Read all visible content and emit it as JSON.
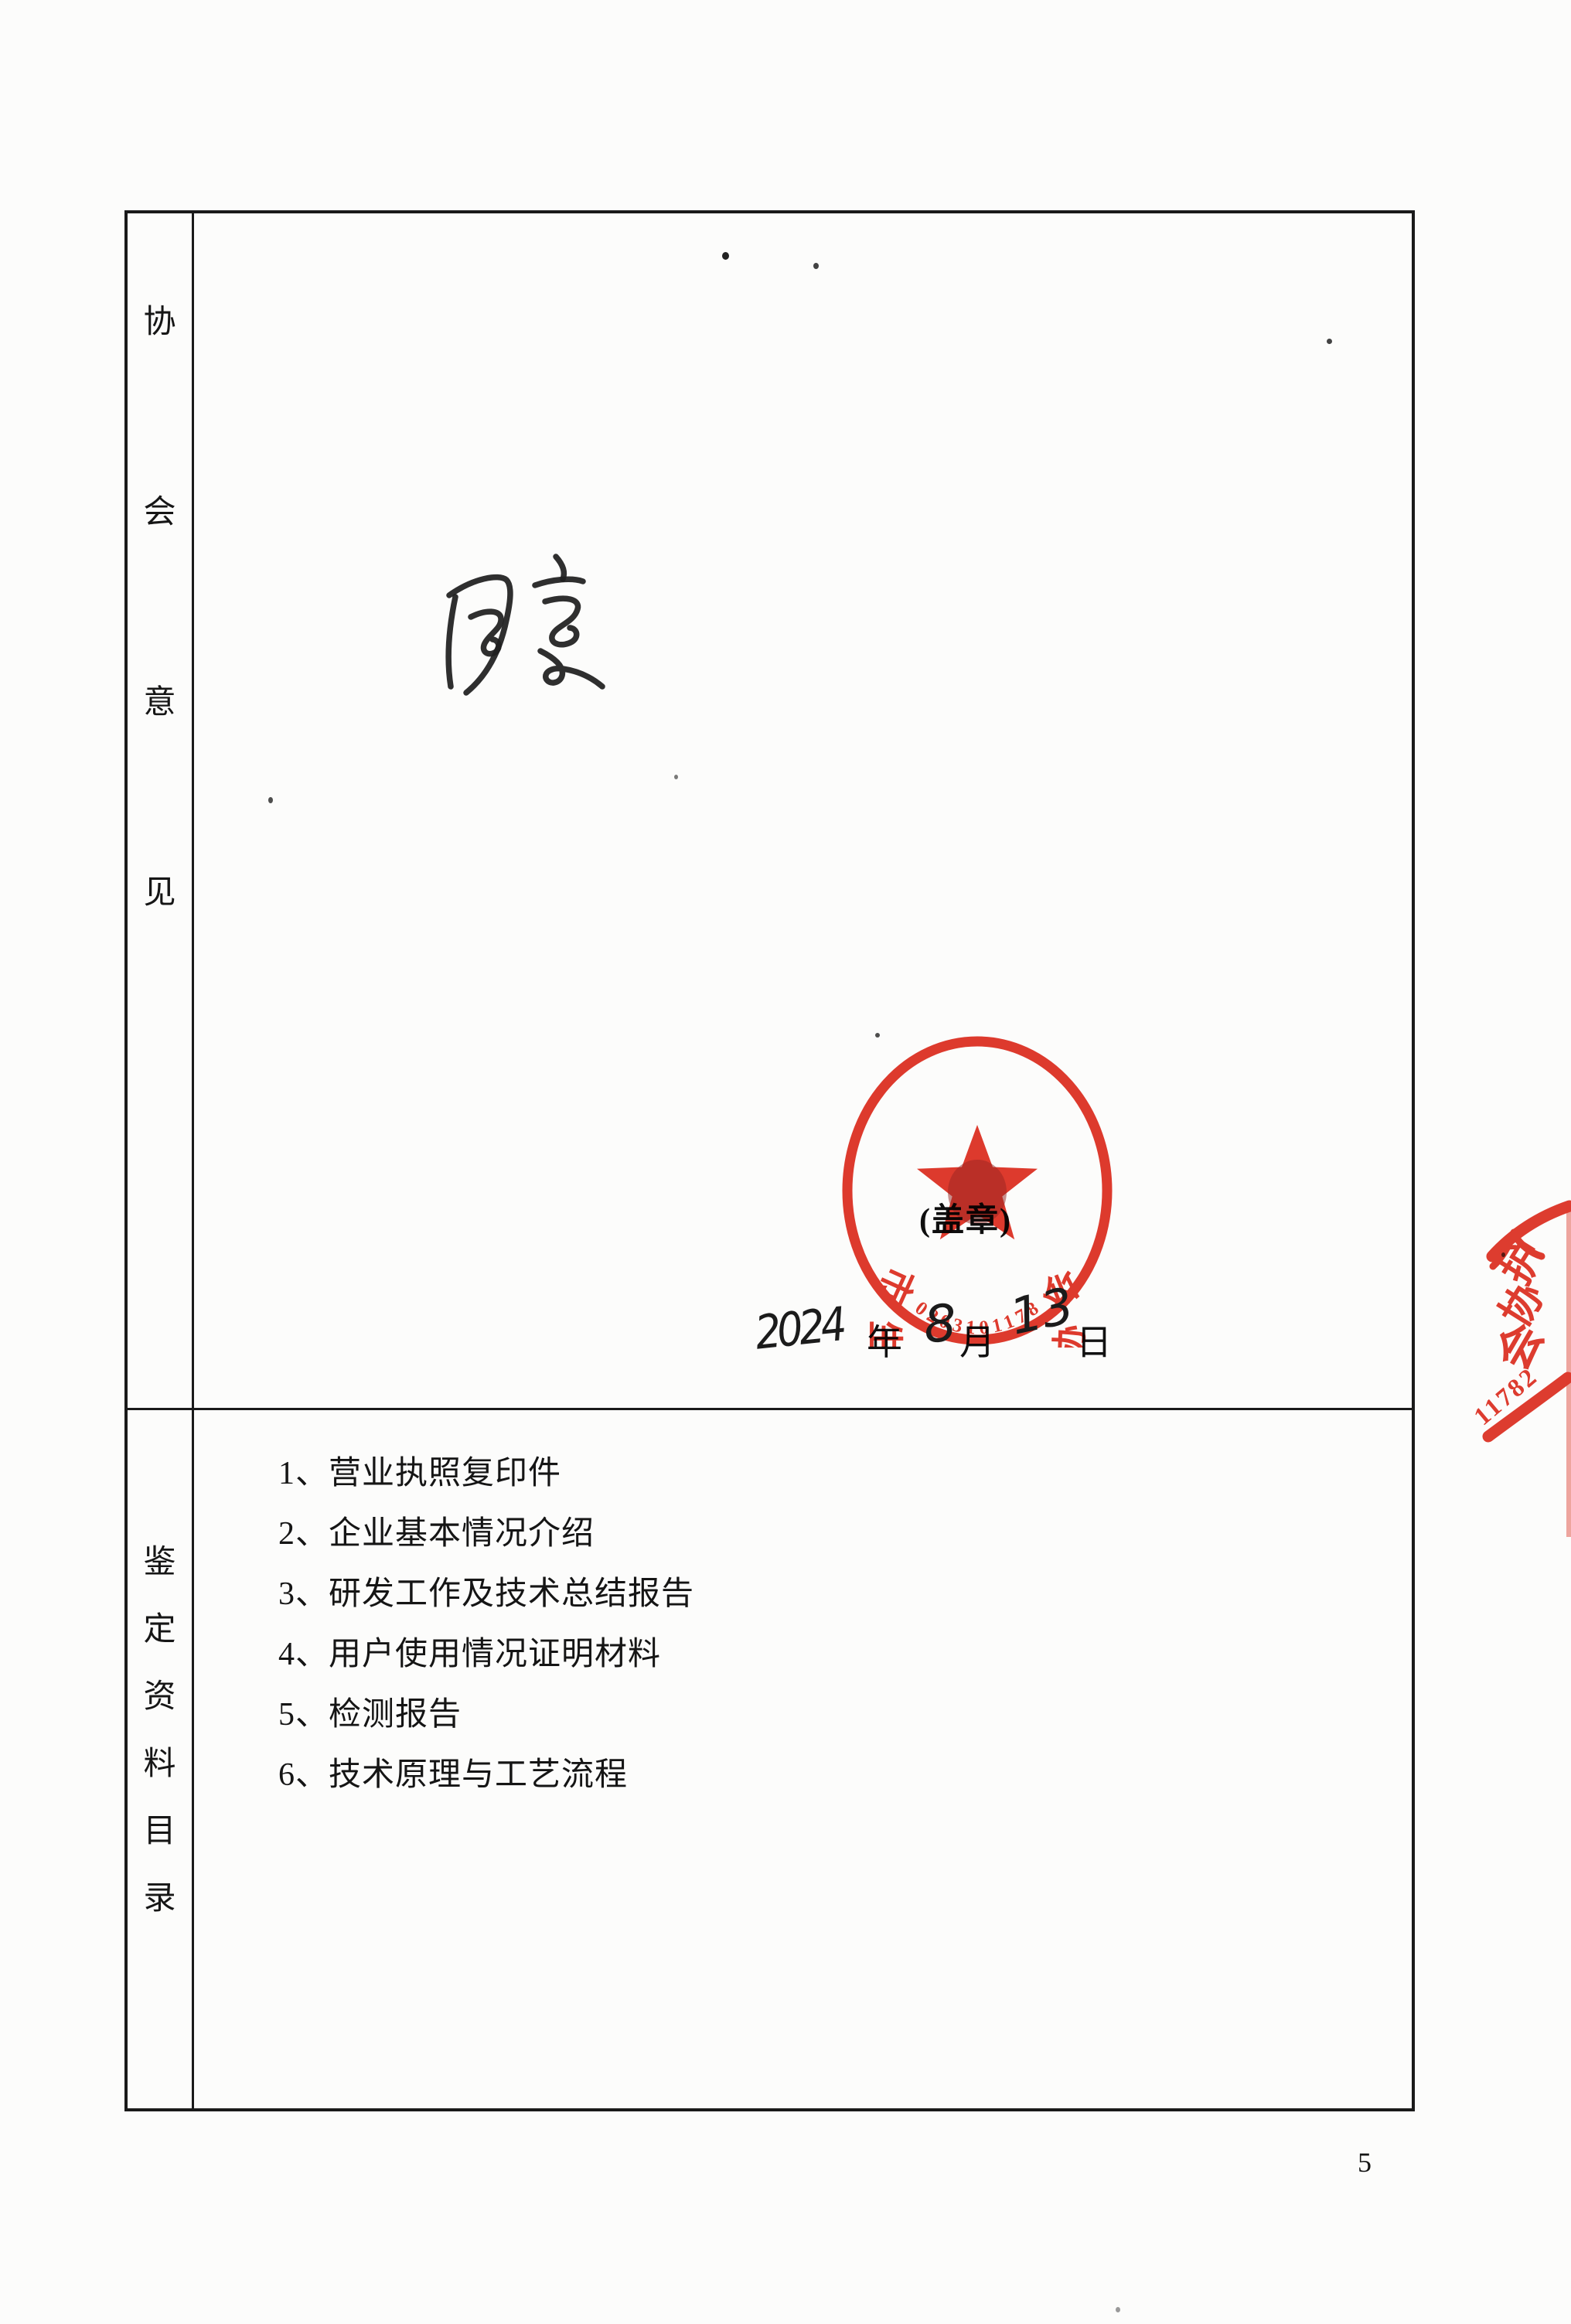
{
  "page": {
    "number": "5"
  },
  "colors": {
    "stamp_red": "#de2b1d",
    "ink": "#1c1c1c",
    "border": "#1a1a1a"
  },
  "table": {
    "rows": [
      {
        "name": "association-opinion",
        "label": "协会意见",
        "label_chars": [
          "协",
          "会",
          "意",
          "见"
        ]
      },
      {
        "name": "appraisal-materials-catalog",
        "label": "鉴定资料目录",
        "label_chars": [
          "鉴",
          "定",
          "资",
          "料",
          "目",
          "录"
        ]
      }
    ]
  },
  "opinion": {
    "handwritten_approval": "同意",
    "stamp_note": "(盖章)",
    "date": {
      "year": "2024",
      "year_unit": "年",
      "month": "8",
      "month_unit": "月",
      "day": "13",
      "day_unit": "日"
    }
  },
  "stamp": {
    "arc_text": "市生态环境保护协会",
    "serial": "02031011782"
  },
  "edge_stamp": {
    "chars": [
      "护",
      "协",
      "会"
    ],
    "digits": "11782"
  },
  "materials": {
    "items": [
      "1、营业执照复印件",
      "2、企业基本情况介绍",
      "3、研发工作及技术总结报告",
      "4、用户使用情况证明材料",
      "5、检测报告",
      "6、技术原理与工艺流程"
    ]
  }
}
